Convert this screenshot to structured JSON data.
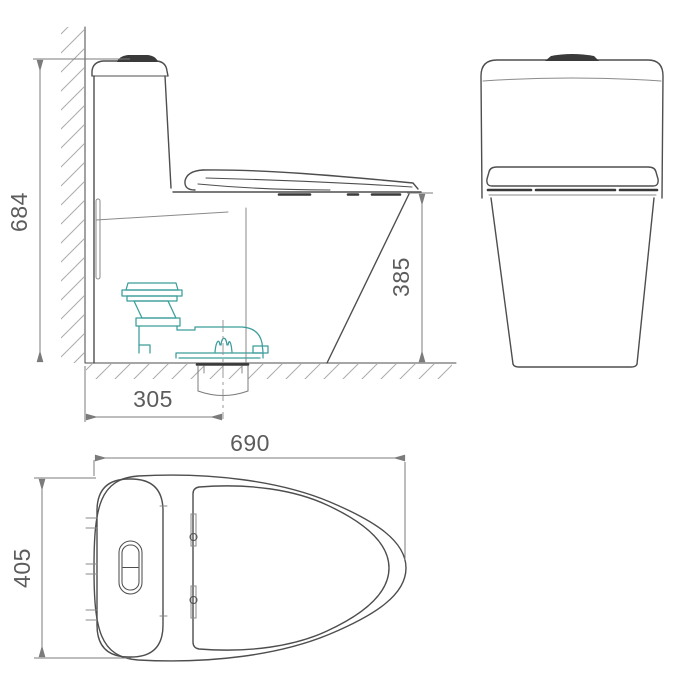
{
  "drawing": {
    "kind": "technical-dimension-drawing",
    "subject": "one-piece toilet, three orthographic views"
  },
  "dimensions": {
    "overall_height": "684",
    "bowl_height": "385",
    "drain_offset": "305",
    "overall_length": "690",
    "overall_width": "405"
  },
  "colors": {
    "line": "#4e4e4e",
    "thin": "#8a8a8a",
    "dim": "#7b7b7b",
    "text": "#5c5c5c",
    "accent": "#3B9D9B",
    "dark": "#3a3a3a",
    "hatch": "#ababab",
    "background": "#ffffff"
  }
}
